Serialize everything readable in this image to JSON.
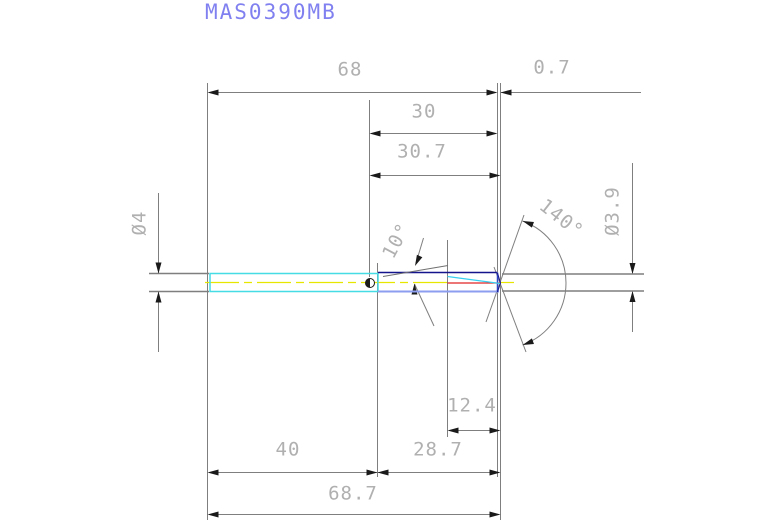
{
  "title": "MAS0390MB",
  "labels": {
    "overall_68": "68",
    "tip_0_7": "0.7",
    "len_30": "30",
    "len_30_7": "30.7",
    "dia_4": "Ø4",
    "dia_3_9": "Ø3.9",
    "angle_140": "140°",
    "angle_10": "10°",
    "len_12_4": "12.4",
    "len_40": "40",
    "len_28_7": "28.7",
    "overall_68_7": "68.7"
  },
  "colors": {
    "background": "#ffffff",
    "title_text": "#8080f0",
    "dimension_text": "#b0b0b0",
    "dimension_line": "#7f7f7f",
    "arrowhead": "#1a1a1a",
    "shank_outline_cyan": "#45dce6",
    "flute_top_navy": "#14148c",
    "flute_bottom_blue": "#8c9ef0",
    "flute_edge_blue": "#2f46c8",
    "centerline_yellow": "#e6e600",
    "tip_line_red": "#e02525",
    "flute_diagonal_cyan": "#38d0f0"
  }
}
